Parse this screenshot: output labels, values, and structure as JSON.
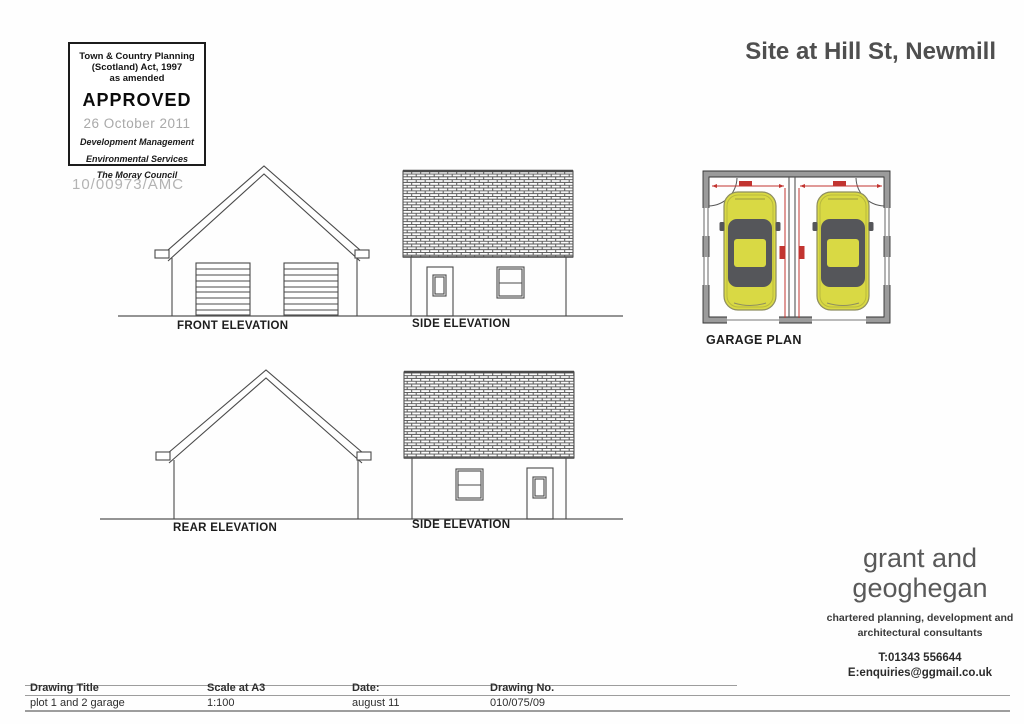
{
  "page": {
    "title": "Site at Hill St, Newmill"
  },
  "stamp": {
    "act_line1": "Town & Country Planning",
    "act_line2": "(Scotland) Act, 1997",
    "act_line3": "as amended",
    "status": "APPROVED",
    "date": "26 October 2011",
    "dept_line1": "Development Management",
    "dept_line2": "Environmental Services",
    "dept_line3": "The Moray Council",
    "reference": "10/00973/AMC"
  },
  "drawings": {
    "front_elevation_label": "FRONT ELEVATION",
    "side_elevation_top_label": "SIDE ELEVATION",
    "garage_plan_label": "GARAGE PLAN",
    "rear_elevation_label": "REAR ELEVATION",
    "side_elevation_bottom_label": "SIDE ELEVATION"
  },
  "firm": {
    "name_line1": "grant and",
    "name_line2": "geoghegan",
    "tagline_line1": "chartered planning, development and",
    "tagline_line2": "architectural consultants",
    "phone": "T:01343 556644",
    "email": "E:enquiries@ggmail.co.uk"
  },
  "title_block": {
    "headers": [
      "Drawing Title",
      "Scale at A3",
      "Date:",
      "Drawing No."
    ],
    "values": [
      "plot 1 and 2 garage",
      "1:100",
      "august 11",
      "010/075/09"
    ]
  },
  "colors": {
    "car_yellow": "#d9d944",
    "car_window_gray": "#55565a",
    "wall_gray": "#9b9b9b",
    "dimension_red": "#c23430",
    "drawing_line": "#4a4a4a"
  }
}
